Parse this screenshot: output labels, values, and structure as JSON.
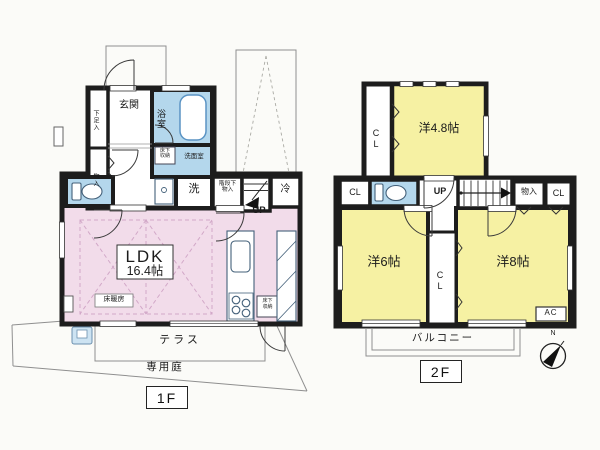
{
  "colors": {
    "wall": "#1d1d1d",
    "ldk_pink": "#f2dcea",
    "room_yellow": "#f6f1a3",
    "wet_blue": "#b4d7ec",
    "line_gray": "#8f8f8f"
  },
  "floor1": {
    "tag": "1F",
    "labels": {
      "genkan": "玄関",
      "shoe_box": "下足入",
      "closet": "物入",
      "bath": "浴室",
      "washroom": "洗面室",
      "underfloor_1": "床下",
      "underfloor_2": "収納",
      "laundry": "洗",
      "stair_store_1": "階段下",
      "stair_store_2": "物入",
      "fridge": "冷",
      "up": "UP",
      "ldk": "LDK",
      "ldk_size": "16.4帖",
      "floor_heating": "床暖房",
      "terrace": "テラス",
      "garden": "専用庭"
    }
  },
  "floor2": {
    "tag": "2F",
    "labels": {
      "room_48": "洋4.8帖",
      "room_6": "洋6帖",
      "room_8": "洋8帖",
      "cl": "CL",
      "closet": "物入",
      "up": "UP",
      "balcony": "バルコニー",
      "ac": "AC",
      "north": "N"
    }
  }
}
